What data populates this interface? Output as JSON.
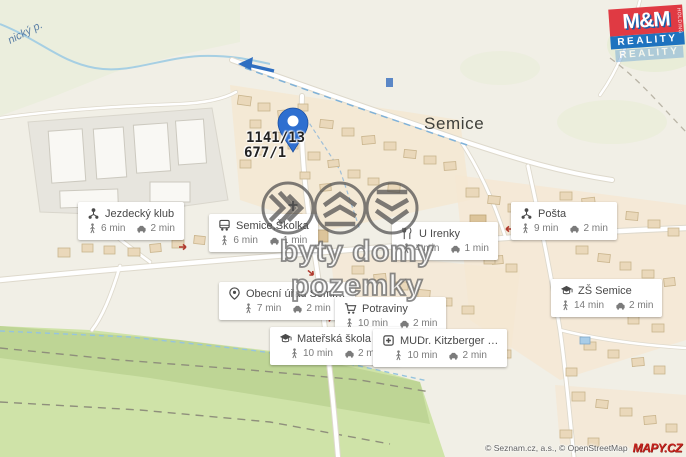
{
  "map": {
    "town_label": "Semice",
    "stream_label": "nický p.",
    "parcel": {
      "line1": "1141/13",
      "line2": "677/1"
    }
  },
  "watermark": {
    "text": "byty domy pozemky"
  },
  "brand_logo": {
    "mm": "M&M",
    "reality": "REALITY",
    "reality_reflection": "REALITY",
    "holding": "HOLDING"
  },
  "attribution": {
    "copyright": "© Seznam.cz, a.s., © OpenStreetMap",
    "logo": "MAPY.CZ"
  },
  "colors": {
    "pin_blue": "#2e6fd0",
    "brand_red": "#e03a43",
    "brand_blue": "#1e73bf",
    "mapy_red": "#c4231d",
    "marker_red": "#b03a2e",
    "green_area": "#cfe3a8",
    "residential_tan": "#f5e7d1"
  },
  "poi_cards": [
    {
      "icon": "category-icon",
      "title": "Jezdecký klub",
      "walk": "6 min",
      "drive": "2 min"
    },
    {
      "icon": "bus-icon",
      "title": "Semice,Školka",
      "walk": "6 min",
      "drive": "1 min"
    },
    {
      "icon": "restaurant-icon",
      "title": "U Irenky",
      "walk": "4 min",
      "drive": "1 min"
    },
    {
      "icon": "category-icon",
      "title": "Pošta",
      "walk": "9 min",
      "drive": "2 min"
    },
    {
      "icon": "pin-icon",
      "title": "Obecní úřad Semi…",
      "walk": "7 min",
      "drive": "2 min"
    },
    {
      "icon": "cart-icon",
      "title": "Potraviny",
      "walk": "10 min",
      "drive": "2 min"
    },
    {
      "icon": "school-icon",
      "title": "ZŠ Semice",
      "walk": "14 min",
      "drive": "2 min"
    },
    {
      "icon": "school-icon",
      "title": "Mateřská škola S…",
      "walk": "10 min",
      "drive": "2 min"
    },
    {
      "icon": "doctor-icon",
      "title": "MUDr. Kitzberger …",
      "walk": "10 min",
      "drive": "2 min"
    }
  ]
}
